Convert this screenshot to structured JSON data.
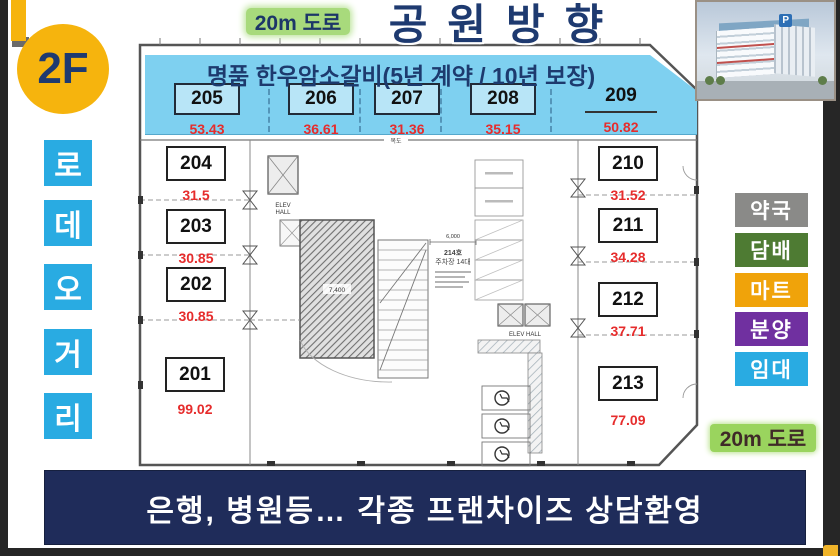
{
  "header": {
    "floor_badge": "2F",
    "road_top": "20m 도로",
    "title": "공원방향"
  },
  "rodeo_street": {
    "letters": [
      "로",
      "데",
      "오",
      "거",
      "리"
    ]
  },
  "banner": {
    "title": "명품 한우암소갈비(5년 계약 / 10년 보장)",
    "units": [
      {
        "no": "205",
        "area": "53.43"
      },
      {
        "no": "206",
        "area": "36.61"
      },
      {
        "no": "207",
        "area": "31.36"
      },
      {
        "no": "208",
        "area": "35.15"
      },
      {
        "no": "209",
        "area": "50.82"
      }
    ]
  },
  "plan": {
    "left_units": [
      {
        "no": "204",
        "area": "31.5"
      },
      {
        "no": "203",
        "area": "30.85"
      },
      {
        "no": "202",
        "area": "30.85"
      },
      {
        "no": "201",
        "area": "99.02"
      }
    ],
    "right_units": [
      {
        "no": "210",
        "area": "31.52"
      },
      {
        "no": "211",
        "area": "34.28"
      },
      {
        "no": "212",
        "area": "37.71"
      },
      {
        "no": "213",
        "area": "77.09"
      }
    ],
    "annotations": {
      "elev_line1": "ELEV",
      "elev_line2": "HALL",
      "elev_hall": "ELEV HALL",
      "corridor": "복도",
      "parking_no": "214호",
      "parking_cap": "주차장 14대",
      "dim_width": "6,000",
      "dim_ramp": "7,400"
    }
  },
  "side_labels": [
    {
      "label": "약국",
      "color": "#8a8a88"
    },
    {
      "label": "담배",
      "color": "#4e7b33"
    },
    {
      "label": "마트",
      "color": "#f0a30a"
    },
    {
      "label": "분양",
      "color": "#7030a0"
    },
    {
      "label": "임대",
      "color": "#29abe2"
    }
  ],
  "building_image": {
    "p_sign": "P"
  },
  "footer": {
    "road_bottom": "20m 도로",
    "banner_text": "은행, 병원등… 각종 프랜차이즈 상담환영"
  },
  "colors": {
    "accent_blue": "#29abe2",
    "navy_text": "#1e3a70",
    "banner_bg": "#7ed0f0",
    "yellow_badge": "#f6b40d",
    "red_area": "#e62c2c",
    "green_highlight": "#9ad45e",
    "bottom_banner_bg": "#1f2c5a"
  }
}
